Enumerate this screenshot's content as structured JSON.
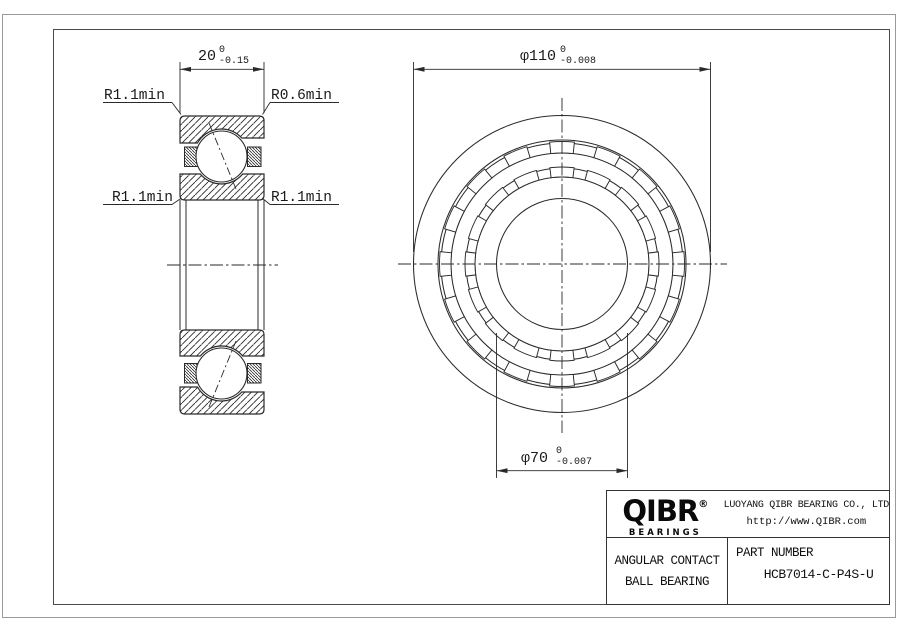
{
  "colors": {
    "line": "#2a2a2a",
    "frame": "#4a4a4a",
    "outer_border": "#9a9a9a",
    "text": "#1a1a1a"
  },
  "section_view": {
    "dim_width": {
      "text": "20",
      "tol_upper": "0",
      "tol_lower": "-0.15"
    },
    "label_top_left": "R1.1min",
    "label_top_right": "R0.6min",
    "label_mid_left": "R1.1min",
    "label_mid_right": "R1.1min"
  },
  "front_view": {
    "dim_od": {
      "text": "φ110",
      "tol_upper": "0",
      "tol_lower": "-0.008"
    },
    "dim_bore": {
      "text": "φ70",
      "tol_upper": "0",
      "tol_lower": "-0.007"
    }
  },
  "title_block": {
    "brand": "QIBR",
    "brand_reg": "®",
    "brand_sub": "BEARINGS",
    "company": "LUOYANG QIBR BEARING CO., LTD",
    "website": "http://www.QIBR.com",
    "type_line1": "ANGULAR CONTACT",
    "type_line2": "BALL BEARING",
    "part_number_label": "PART NUMBER",
    "part_number": "HCB7014-C-P4S-U"
  }
}
